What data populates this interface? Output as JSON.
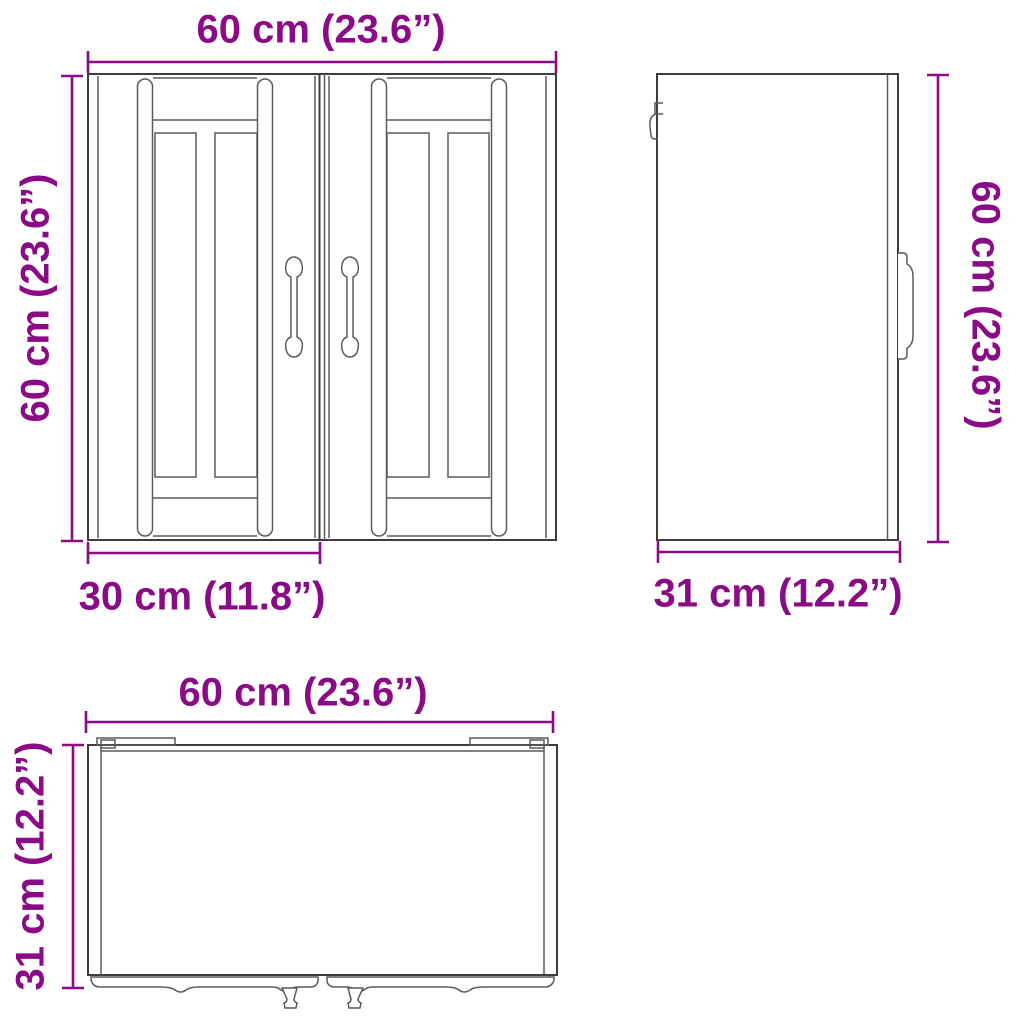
{
  "colors": {
    "dimension_accent": "#8b0a86",
    "drawing_line": "#3d3d3d",
    "background": "#ffffff"
  },
  "views": {
    "front": {
      "width": "60 cm (23.6”)",
      "height": "60 cm (23.6”)",
      "door_width": "30 cm (11.8”)"
    },
    "side": {
      "height": "60 cm (23.6”)",
      "depth": "31 cm (12.2”)"
    },
    "top": {
      "width": "60 cm (23.6”)",
      "depth": "31 cm (12.2”)"
    }
  }
}
